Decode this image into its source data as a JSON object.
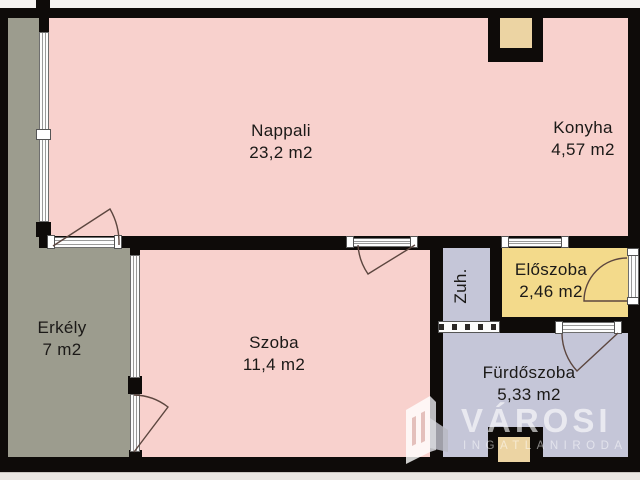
{
  "floorplan": {
    "rooms": {
      "nappali": {
        "name": "Nappali",
        "area": "23,2 m2"
      },
      "konyha": {
        "name": "Konyha",
        "area": "4,57 m2"
      },
      "erkely": {
        "name": "Erkély",
        "area": "7 m2"
      },
      "szoba": {
        "name": "Szoba",
        "area": "11,4 m2"
      },
      "zuhanyzo": {
        "name": "Zuh."
      },
      "eloszoba": {
        "name": "Előszoba",
        "area": "2,46 m2"
      },
      "furdoszoba": {
        "name": "Fürdőszoba",
        "area": "5,33 m2"
      }
    },
    "colors": {
      "living_areas": "#f8d1cd",
      "balcony": "#9c9c8e",
      "hallway": "#f3da8b",
      "bathroom_shower": "#c5c6d8",
      "shaft": "#ecd4a3",
      "walls": "#0e0b09",
      "background": "#f5f3f0"
    },
    "watermark": {
      "brand": "VÁROSI",
      "subtitle": "INGATLANIRODA"
    }
  }
}
